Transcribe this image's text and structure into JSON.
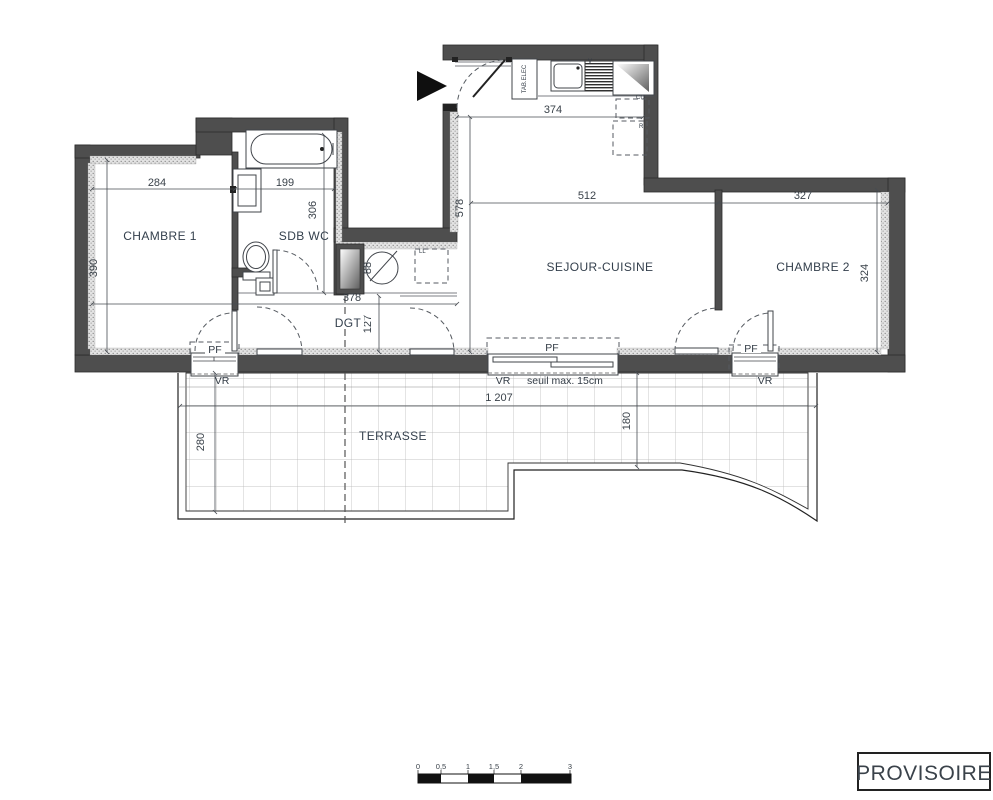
{
  "stamp": "PROVISOIRE",
  "rooms": {
    "chambre1": "CHAMBRE 1",
    "sdb": "SDB WC",
    "sejour": "SEJOUR-CUISINE",
    "chambre2": "CHAMBRE 2",
    "dgt": "DGT",
    "terrasse": "TERRASSE"
  },
  "dims": {
    "d284": "284",
    "d199": "199",
    "d306": "306",
    "d390": "390",
    "d374": "374",
    "d512": "512",
    "d327": "327",
    "d578": "578",
    "d324": "324",
    "d88": "88",
    "d378": "378",
    "d127": "127",
    "d1207": "1 207",
    "d280": "280",
    "d180": "180"
  },
  "openings": {
    "pf": "PF",
    "vr": "VR",
    "seuil": "seuil max. 15cm"
  },
  "equipment": {
    "tab_elec": "TAB.ELEC",
    "hood": "V",
    "cuisine": "CU",
    "fridge": "R",
    "washer": "LL"
  },
  "scale_bar": {
    "t0": "0",
    "t05": "0,5",
    "t1": "1",
    "t15": "1,5",
    "t2": "2",
    "t3": "3"
  },
  "colors": {
    "wall": "#4e4e4e",
    "text": "#3a424a",
    "stamp_border": "#222222"
  }
}
